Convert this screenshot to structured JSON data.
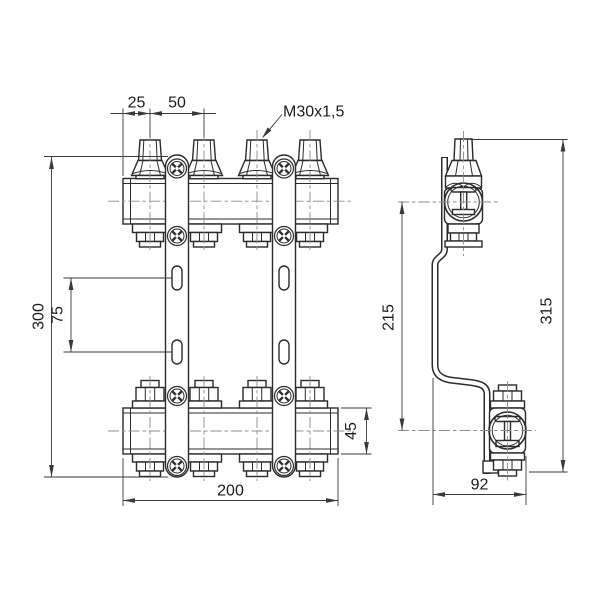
{
  "drawing": {
    "front_view": {
      "dims": {
        "pitch_first": "25",
        "pitch": "50",
        "thread": "M30x1,5",
        "bracket_height": "300",
        "slot_spacing": "75",
        "length": "200",
        "tube_height": "45"
      }
    },
    "side_view": {
      "dims": {
        "axis_distance": "215",
        "overall_height": "315",
        "depth": "92"
      }
    },
    "colors": {
      "background": "#ffffff",
      "outline": "#2b2b2b",
      "dimension": "#3a3a3a",
      "centerline": "#8c8c8c",
      "text": "#1c1c1c"
    }
  }
}
